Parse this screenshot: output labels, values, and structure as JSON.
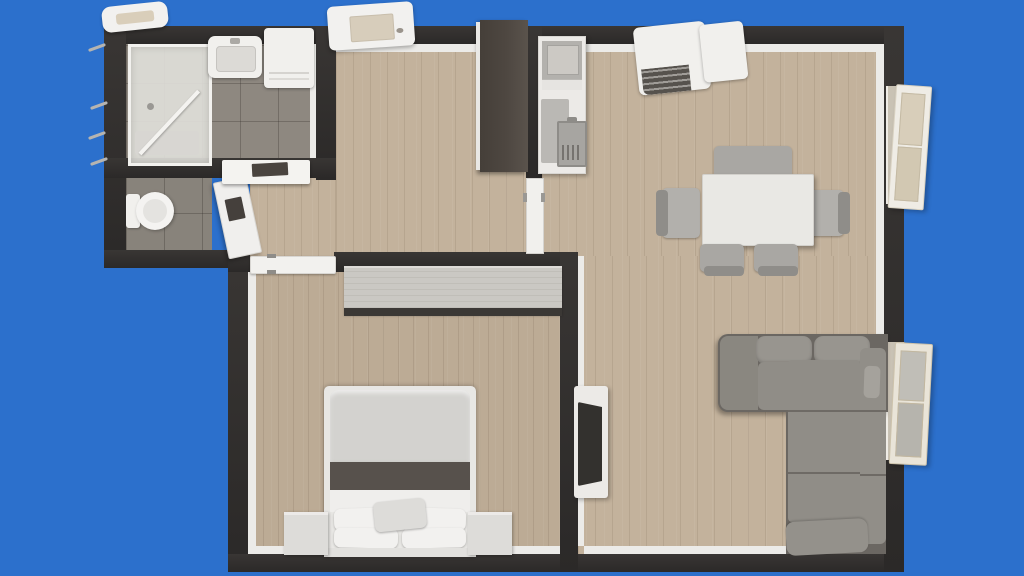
{
  "scene": {
    "type": "3d-floor-plan-top-view",
    "description": "Top-down 3D render of a one-bedroom apartment floor plan on a solid blue background. No text labels visible.",
    "rooms": [
      {
        "name": "bathroom",
        "floor": "gray-tile",
        "furniture": [
          "glass-shower",
          "wash-basin",
          "washing-machine"
        ]
      },
      {
        "name": "toilet-room",
        "floor": "gray-tile",
        "furniture": [
          "toilet",
          "open-door"
        ]
      },
      {
        "name": "hallway",
        "floor": "light-wood",
        "furniture": [
          "dark-wardrobe",
          "wall-cabinet",
          "pocket-door",
          "bedroom-sliding-door"
        ]
      },
      {
        "name": "kitchen",
        "floor": "light-wood",
        "furniture": [
          "counter-with-sink",
          "cooktop",
          "drying-mat",
          "stove-oven-unit"
        ]
      },
      {
        "name": "dining-area",
        "floor": "light-wood",
        "furniture": [
          "dining-table",
          "bench",
          "chair-left",
          "chair-right",
          "chair-bottom-1",
          "chair-bottom-2"
        ]
      },
      {
        "name": "living-room",
        "floor": "light-wood",
        "furniture": [
          "l-shaped-sofa",
          "tv-stand",
          "tv"
        ]
      },
      {
        "name": "bedroom",
        "floor": "light-wood",
        "furniture": [
          "double-bed",
          "pillows",
          "nightstand-left",
          "nightstand-right",
          "light-wardrobe"
        ]
      }
    ],
    "exterior_elements": [
      "skylight-top-left",
      "ceiling-unit-top-center",
      "open-window-top-right",
      "open-window-bottom-right",
      "wall-hinges-left"
    ]
  },
  "palette": {
    "bg_blue": "#2C70CC",
    "wall_dark": "#2B2928",
    "wall_face": "#393634",
    "lining": "#ECEBE8",
    "wood_light": "#C3B29C",
    "wood_bedroom": "#BCAB95",
    "tile": "#8E8880",
    "tile_line": "rgba(45,40,36,0.28)",
    "white_fixture": "#F1F0ED",
    "gray_appliance": "#B3B1AD",
    "wardrobe_dark": "#4E4741",
    "wardrobe_light": "#CAC8C3",
    "sofa_base": "#6B6762",
    "sofa_cushion": "#908D87",
    "sofa_cushion_light": "#98958F",
    "table_white": "#E9E8E4",
    "chair_gray": "#A9A7A3",
    "chair_dark": "#8F8D89",
    "bed_duvet": "#D3D2CF",
    "bed_stripe": "#57514C",
    "pillow_white": "#F2F1EF",
    "tv_screen": "#33312E",
    "shutter_beige": "#D8CEBA",
    "glass": "rgba(186,184,178,0.88)"
  }
}
